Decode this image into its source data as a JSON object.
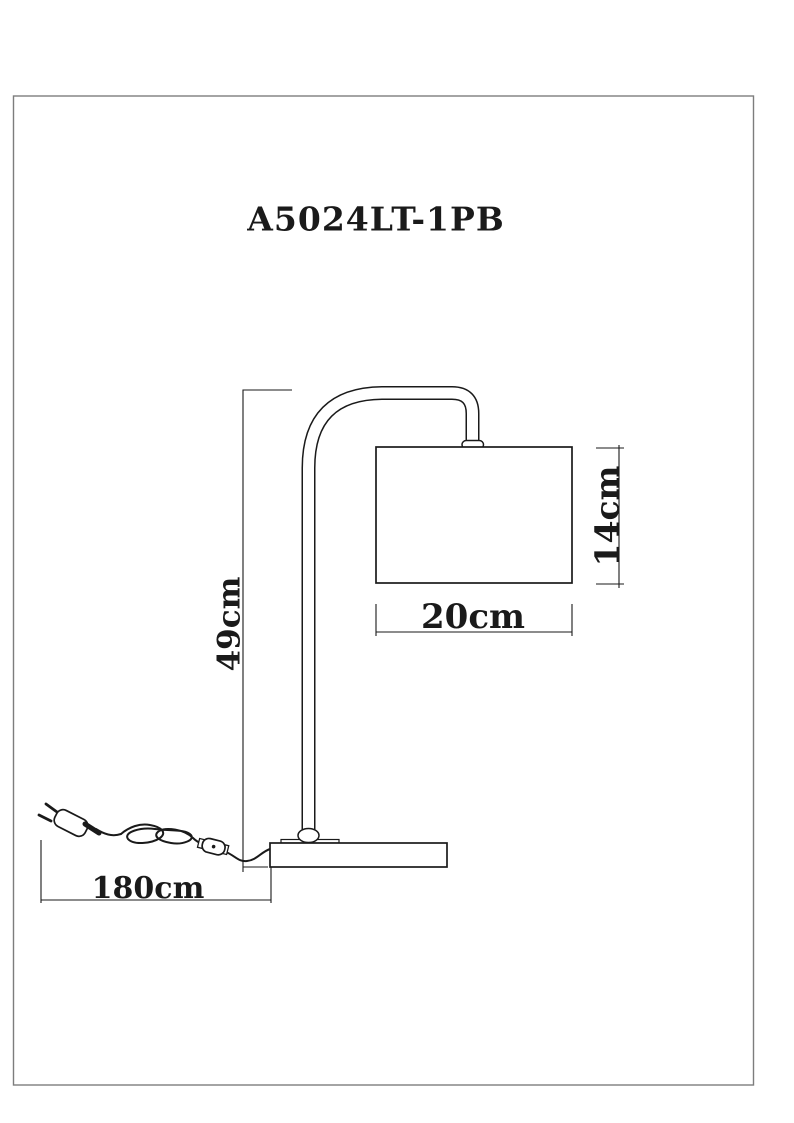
{
  "page": {
    "background_color": "#ffffff",
    "frame_border_color": "#7d7d7d"
  },
  "drawing": {
    "title": "A5024LT-1PB",
    "line_color": "#1a1a1a",
    "dimension_labels": {
      "overall_height": "49cm",
      "shade_height": "14cm",
      "shade_width": "20cm",
      "cord_length": "180cm"
    }
  }
}
